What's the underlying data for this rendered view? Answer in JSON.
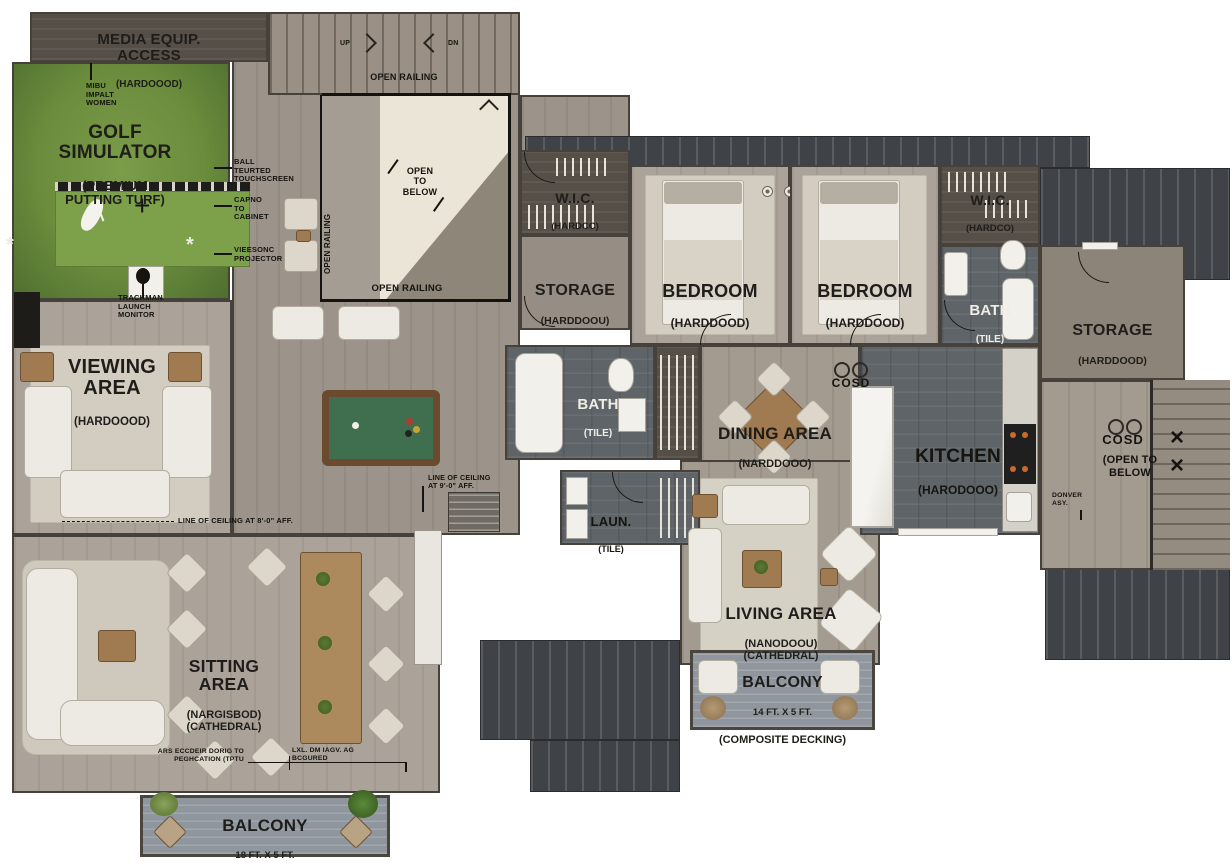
{
  "rooms": {
    "media_access": {
      "name": "MEDIA EQUIP.\nACCESS",
      "material": "(HARDOOOD)"
    },
    "golf_simulator": {
      "name": "GOLF\nSIMULATOR",
      "material": "(PREMIUM\nPUTTING TURF)"
    },
    "viewing_area": {
      "name": "VIEWING\nAREA",
      "material": "(HARDOOOD)"
    },
    "sitting_area": {
      "name": "SITTING\nAREA",
      "material": "(NARGISBOD)\n(CATHEDRAL)"
    },
    "storage_left": {
      "name": "STORAGE",
      "material": "(HARDDOOU)"
    },
    "wic_left": {
      "name": "W.I.C.",
      "material": "(HARDCC)"
    },
    "bedroom_left": {
      "name": "BEDROOM",
      "material": "(HARDDOOD)"
    },
    "bedroom_right": {
      "name": "BEDROOM",
      "material": "(HARDDOOD)"
    },
    "wic_right": {
      "name": "W.I.C.",
      "material": "(HARDCO)"
    },
    "bath_right": {
      "name": "BATH",
      "material": "(TILE)"
    },
    "storage_right": {
      "name": "STORAGE",
      "material": "(HARDDOOD)"
    },
    "bath_center": {
      "name": "BATH",
      "material": "(TILE)"
    },
    "dining_area": {
      "name": "DINING AREA",
      "material": "(NARDDOOO)"
    },
    "kitchen": {
      "name": "KITCHEN",
      "material": "(HARODOOO)"
    },
    "laundry": {
      "name": "LAUN.",
      "material": "(TILE)"
    },
    "living_area": {
      "name": "LIVING AREA",
      "material": "(NANODOOU)\n(CATHEDRAL)"
    },
    "balcony_center": {
      "name": "BALCONY",
      "dims": "14 FT. X 5 FT.",
      "material": "(COMPOSITE DECKING)"
    },
    "balcony_left": {
      "name": "BALCONY",
      "dims": "18 FT. X 5 FT.",
      "material": "(COMPOSITE DECKING)"
    }
  },
  "annotations": {
    "impact_screen": "MIBU\nIMPALT\nWOMEN",
    "touchscreen": "BALL\nTEURTED\nTOUCHSCREEN",
    "cabinet": "CAPNO\nTO\nCABINET",
    "projector": "VIEESONC\nPROJECTOR",
    "trackman": "TRACKMAN\nLAUNCH\nMONITOR",
    "open_railing_top": "OPEN RAILING",
    "open_railing_bottom": "OPEN RAILING",
    "open_railing_side": "OPEN RAILING",
    "open_to_below_stairs": "OPEN\nTO\nBELOW",
    "stairs_up": "UP",
    "stairs_dn": "DN",
    "cosd_center": "COSD",
    "cosd_right": "COSD",
    "open_to_below_right": "(OPEN TO\nBELOW",
    "dormer": "DONVER\nASY.",
    "ceiling_9": "LINE OF CEILING\nAT 9'-0\" AFF.",
    "ceiling_8": "LINE OF CEILING AT 8'-0\" AFF.",
    "note_left": "ARS ECCDEIR DORIG TO\nPEGHCATION (TPTU",
    "note_right": "LXL. DM IAGV. AG\nBCGURED"
  },
  "colors": {
    "turf": "#6a8c3c",
    "roof": "#3f4246",
    "tile": "#5e6468",
    "wood": "#a39a90",
    "cream": "#ebe5d7",
    "deck": "#8f969d"
  }
}
